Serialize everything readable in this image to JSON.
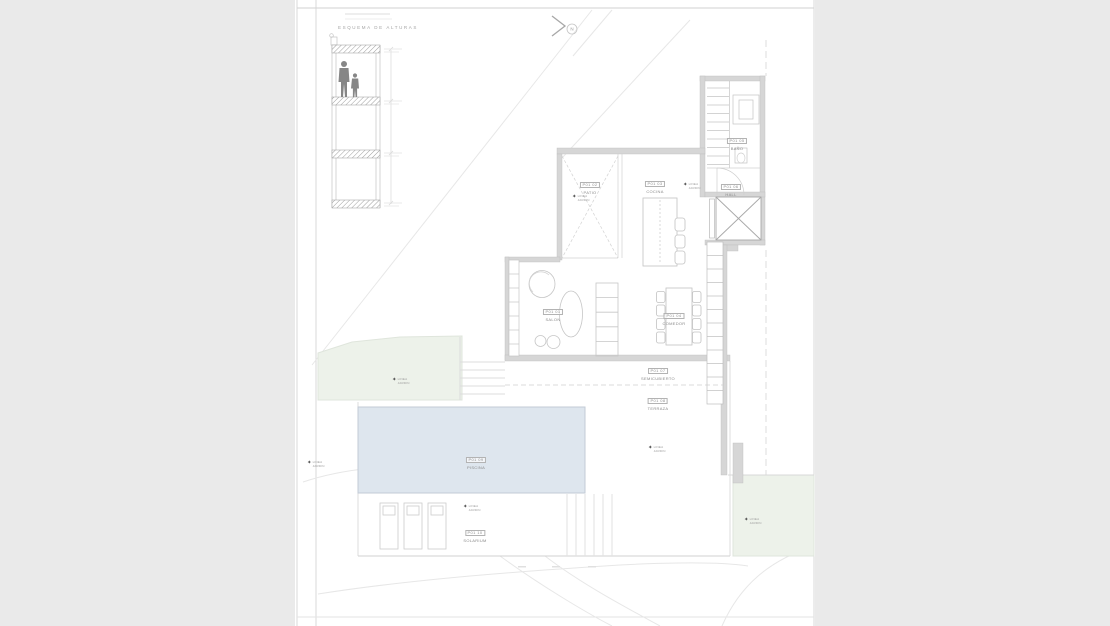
{
  "colors": {
    "canvas": "#eaeaea",
    "paper": "#ffffff",
    "wall": "#d6d6d6",
    "line": "#c8c8c8",
    "pool": "#dee6ee",
    "green": "#edf2ea"
  },
  "north": {
    "label": "N"
  },
  "section": {
    "title": "ESQUEMA DE ALTURAS"
  },
  "plant_marker": {
    "line1": "LINEA",
    "line2": "JARDIN"
  },
  "rooms": [
    {
      "code": "P01 01",
      "name": "SALON"
    },
    {
      "code": "P01 02",
      "name": "PATIO"
    },
    {
      "code": "P01 03",
      "name": "COCINA"
    },
    {
      "code": "P01 04",
      "name": "COMEDOR"
    },
    {
      "code": "P01 05",
      "name": "BAÑO"
    },
    {
      "code": "P01 06",
      "name": "HALL"
    },
    {
      "code": "P01 07",
      "name": "SEMICUBIERTO"
    },
    {
      "code": "P01 08",
      "name": "TERRAZA"
    },
    {
      "code": "P01 09",
      "name": "PISCINA"
    },
    {
      "code": "P01 10",
      "name": "SOLARIUM"
    }
  ]
}
